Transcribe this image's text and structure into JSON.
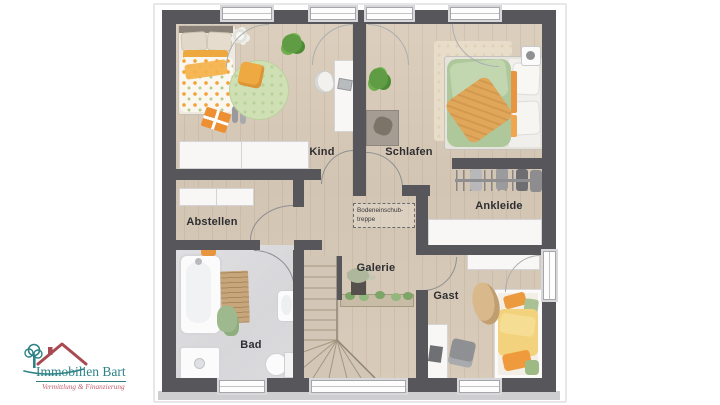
{
  "brand": {
    "name": "Immobilien Bart",
    "tagline": "Vermittlung & Finanzierung"
  },
  "plan": {
    "rooms": {
      "kind": "Kind",
      "schlafen": "Schlafen",
      "abstellen": "Abstellen",
      "ankleide": "Ankleide",
      "bad": "Bad",
      "galerie": "Galerie",
      "gast": "Gast"
    },
    "notes": {
      "attic_line1": "Bodeneinschub-",
      "attic_line2": "treppe"
    }
  },
  "colors": {
    "wall": "#57575b",
    "wood_floor": "#d5c8b6",
    "tile_floor": "#dadadd",
    "brand_teal": "#2e8286",
    "brand_red": "#c4606e",
    "accent_orange": "#eb9a3e",
    "accent_green": "#aec79b"
  }
}
